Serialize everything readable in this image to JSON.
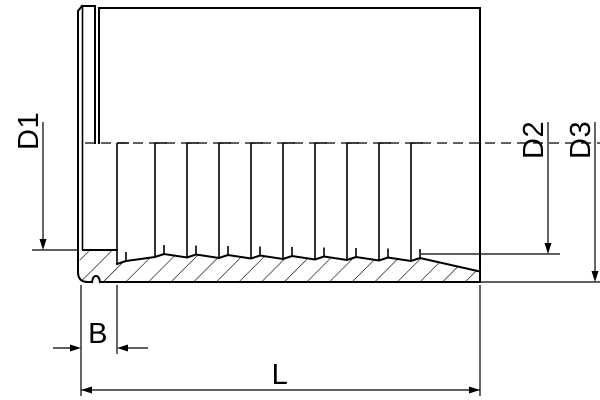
{
  "drawing": {
    "title": "hose-ferrule-section-drawing",
    "labels": {
      "d1": "D1",
      "d2": "D2",
      "d3": "D3",
      "b": "B",
      "l": "L"
    },
    "colors": {
      "line": "#000000",
      "background": "#ffffff"
    }
  }
}
